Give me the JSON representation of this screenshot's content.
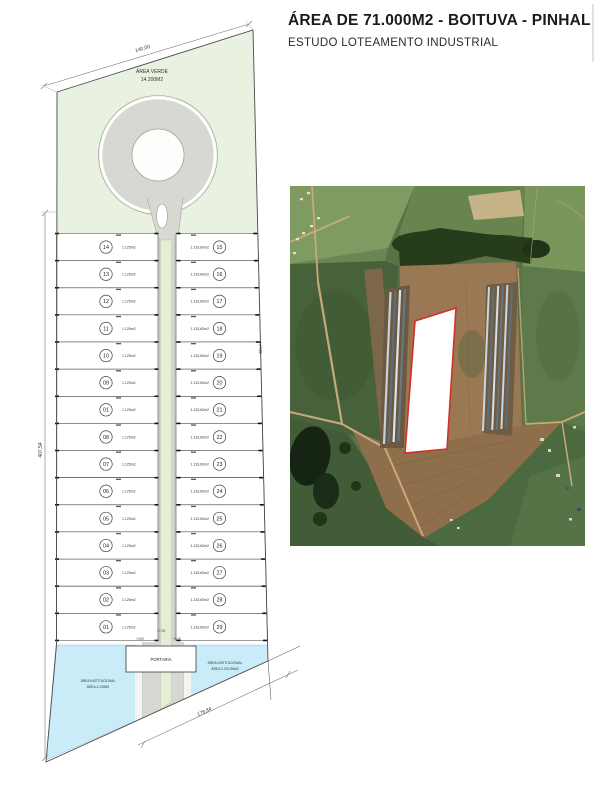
{
  "title": {
    "main": "ÁREA DE 71.000M2 - BOITUVA - PINHAL",
    "subtitle": "ESTUDO LOTEAMENTO INDUSTRIAL"
  },
  "plan": {
    "colors": {
      "green": "#e9f1e0",
      "water": "#c9ecf8",
      "road": "#d8d8d3"
    },
    "area_verde": {
      "label": "ÁREA VERDE",
      "area": "14.200M2"
    },
    "portaria_label": "PORTARIA",
    "institutional_left": {
      "line1": "ÁREA INSTITUCIONAL",
      "line2": "ÁREA 4.130M2"
    },
    "institutional_right": {
      "line1": "ÁREA INSTITUCIONAL",
      "line2": "ÁREA 2.370,96M2"
    },
    "dimensions": {
      "top": "140,00",
      "left": "407,54",
      "right": "433,77",
      "bottom": "178,84",
      "road_width": "17,00",
      "level_left": "+0,00",
      "level_right": "+0,00"
    },
    "left_lots": [
      {
        "num": "14",
        "area": "1.125m2"
      },
      {
        "num": "13",
        "area": "1.125m2"
      },
      {
        "num": "12",
        "area": "1.125m2"
      },
      {
        "num": "11",
        "area": "1.125m2"
      },
      {
        "num": "10",
        "area": "1.125m2"
      },
      {
        "num": "09",
        "area": "1.125m2"
      },
      {
        "num": "01",
        "area": "1.125m2"
      },
      {
        "num": "08",
        "area": "1.125m2"
      },
      {
        "num": "07",
        "area": "1.125m2"
      },
      {
        "num": "06",
        "area": "1.125m2"
      },
      {
        "num": "05",
        "area": "1.125m2"
      },
      {
        "num": "04",
        "area": "1.125m2"
      },
      {
        "num": "03",
        "area": "1.125m2"
      },
      {
        "num": "02",
        "area": "1.125m2"
      },
      {
        "num": "01",
        "area": "1.125m2"
      }
    ],
    "right_lots": [
      {
        "num": "15",
        "area": "1.133,60m2"
      },
      {
        "num": "16",
        "area": "1.133,60m2"
      },
      {
        "num": "17",
        "area": "1.133,60m2"
      },
      {
        "num": "18",
        "area": "1.133,60m2"
      },
      {
        "num": "19",
        "area": "1.133,60m2"
      },
      {
        "num": "20",
        "area": "1.133,60m2"
      },
      {
        "num": "21",
        "area": "1.133,60m2"
      },
      {
        "num": "22",
        "area": "1.133,60m2"
      },
      {
        "num": "23",
        "area": "1.133,60m2"
      },
      {
        "num": "24",
        "area": "1.133,60m2"
      },
      {
        "num": "25",
        "area": "1.133,60m2"
      },
      {
        "num": "26",
        "area": "1.133,60m2"
      },
      {
        "num": "27",
        "area": "1.133,60m2"
      },
      {
        "num": "28",
        "area": "1.133,60m2"
      },
      {
        "num": "29",
        "area": "1.133,60m2"
      }
    ]
  },
  "satellite": {
    "outline_color": "#d03026"
  }
}
